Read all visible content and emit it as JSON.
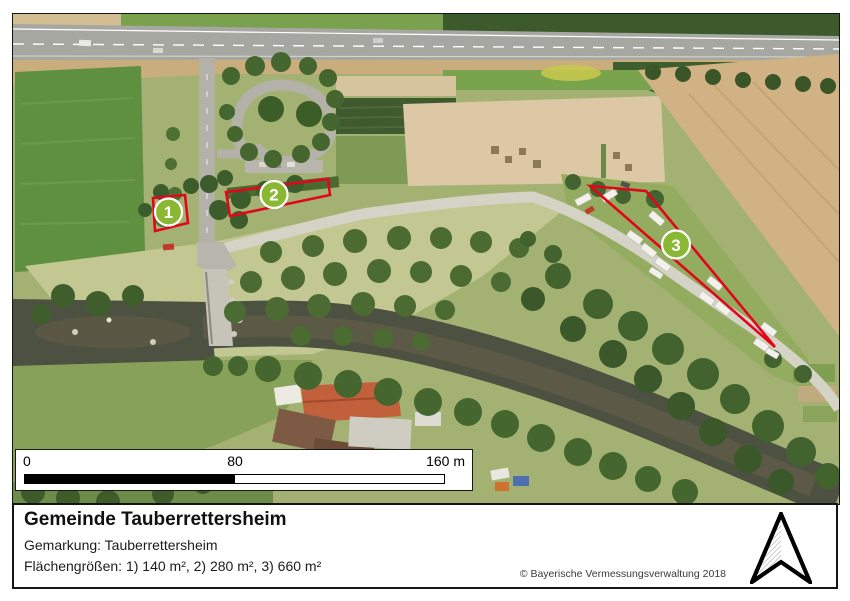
{
  "map": {
    "markers": [
      {
        "label": "1",
        "area": "140 m²"
      },
      {
        "label": "2",
        "area": "280 m²"
      },
      {
        "label": "3",
        "area": "660 m²"
      }
    ],
    "colors": {
      "area_outline": "#e2061a",
      "marker_fill": "#8ab832",
      "marker_ring": "#ffffff"
    }
  },
  "scalebar": {
    "tick_start": "0",
    "tick_mid": "80",
    "tick_end": "160 m"
  },
  "panel": {
    "title": "Gemeinde Tauberrettersheim",
    "subtitle": "Gemarkung: Tauberrettersheim",
    "areas": "Flächengrößen: 1) 140 m², 2) 280 m², 3) 660 m²",
    "attribution": "© Bayerische Vermessungsverwaltung 2018"
  },
  "icons": {
    "north_arrow": "north-arrow-icon"
  }
}
